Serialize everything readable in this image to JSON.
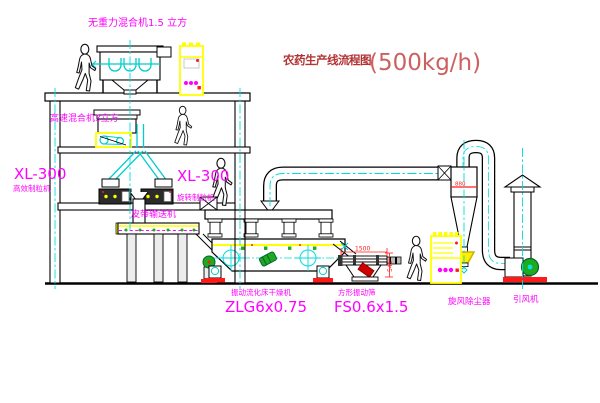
{
  "title": {
    "text_cn": "农药生产线流程图",
    "text_capacity": "(500kg/h)"
  },
  "equipment_labels": {
    "gravity_mixer": "无重力混合机1.5 立方",
    "high_speed_mixer": "高速混合机3立方",
    "granulator_left_model": "XL-300",
    "granulator_left_name": "高效制粒机",
    "granulator_right_model": "XL-300",
    "granulator_right_name": "旋转制粒机",
    "belt_conveyor": "皮带输送机",
    "fluid_bed_dryer_name": "振动流化床干燥机",
    "fluid_bed_dryer_model": "ZLG6x0.75",
    "vibrating_screen_name": "方形振动筛",
    "vibrating_screen_model": "FS0.6x1.5",
    "cyclone_dust_collector": "旋风除尘器",
    "induced_draft_fan": "引风机"
  },
  "dimensions": {
    "screen_length": "1500",
    "screen_height": "541",
    "cyclone_level_mark": "880"
  },
  "colors": {
    "label_magenta": "#ff00ff",
    "title_red": "#b23333",
    "capacity_red": "#cd6060",
    "line_black": "#000000",
    "equipment_yellow": "#ffff00",
    "centerline_cyan": "#00dddd",
    "machine_green": "#1faa1f",
    "dimension_red": "#ff1a1a",
    "background": "#ffffff"
  }
}
